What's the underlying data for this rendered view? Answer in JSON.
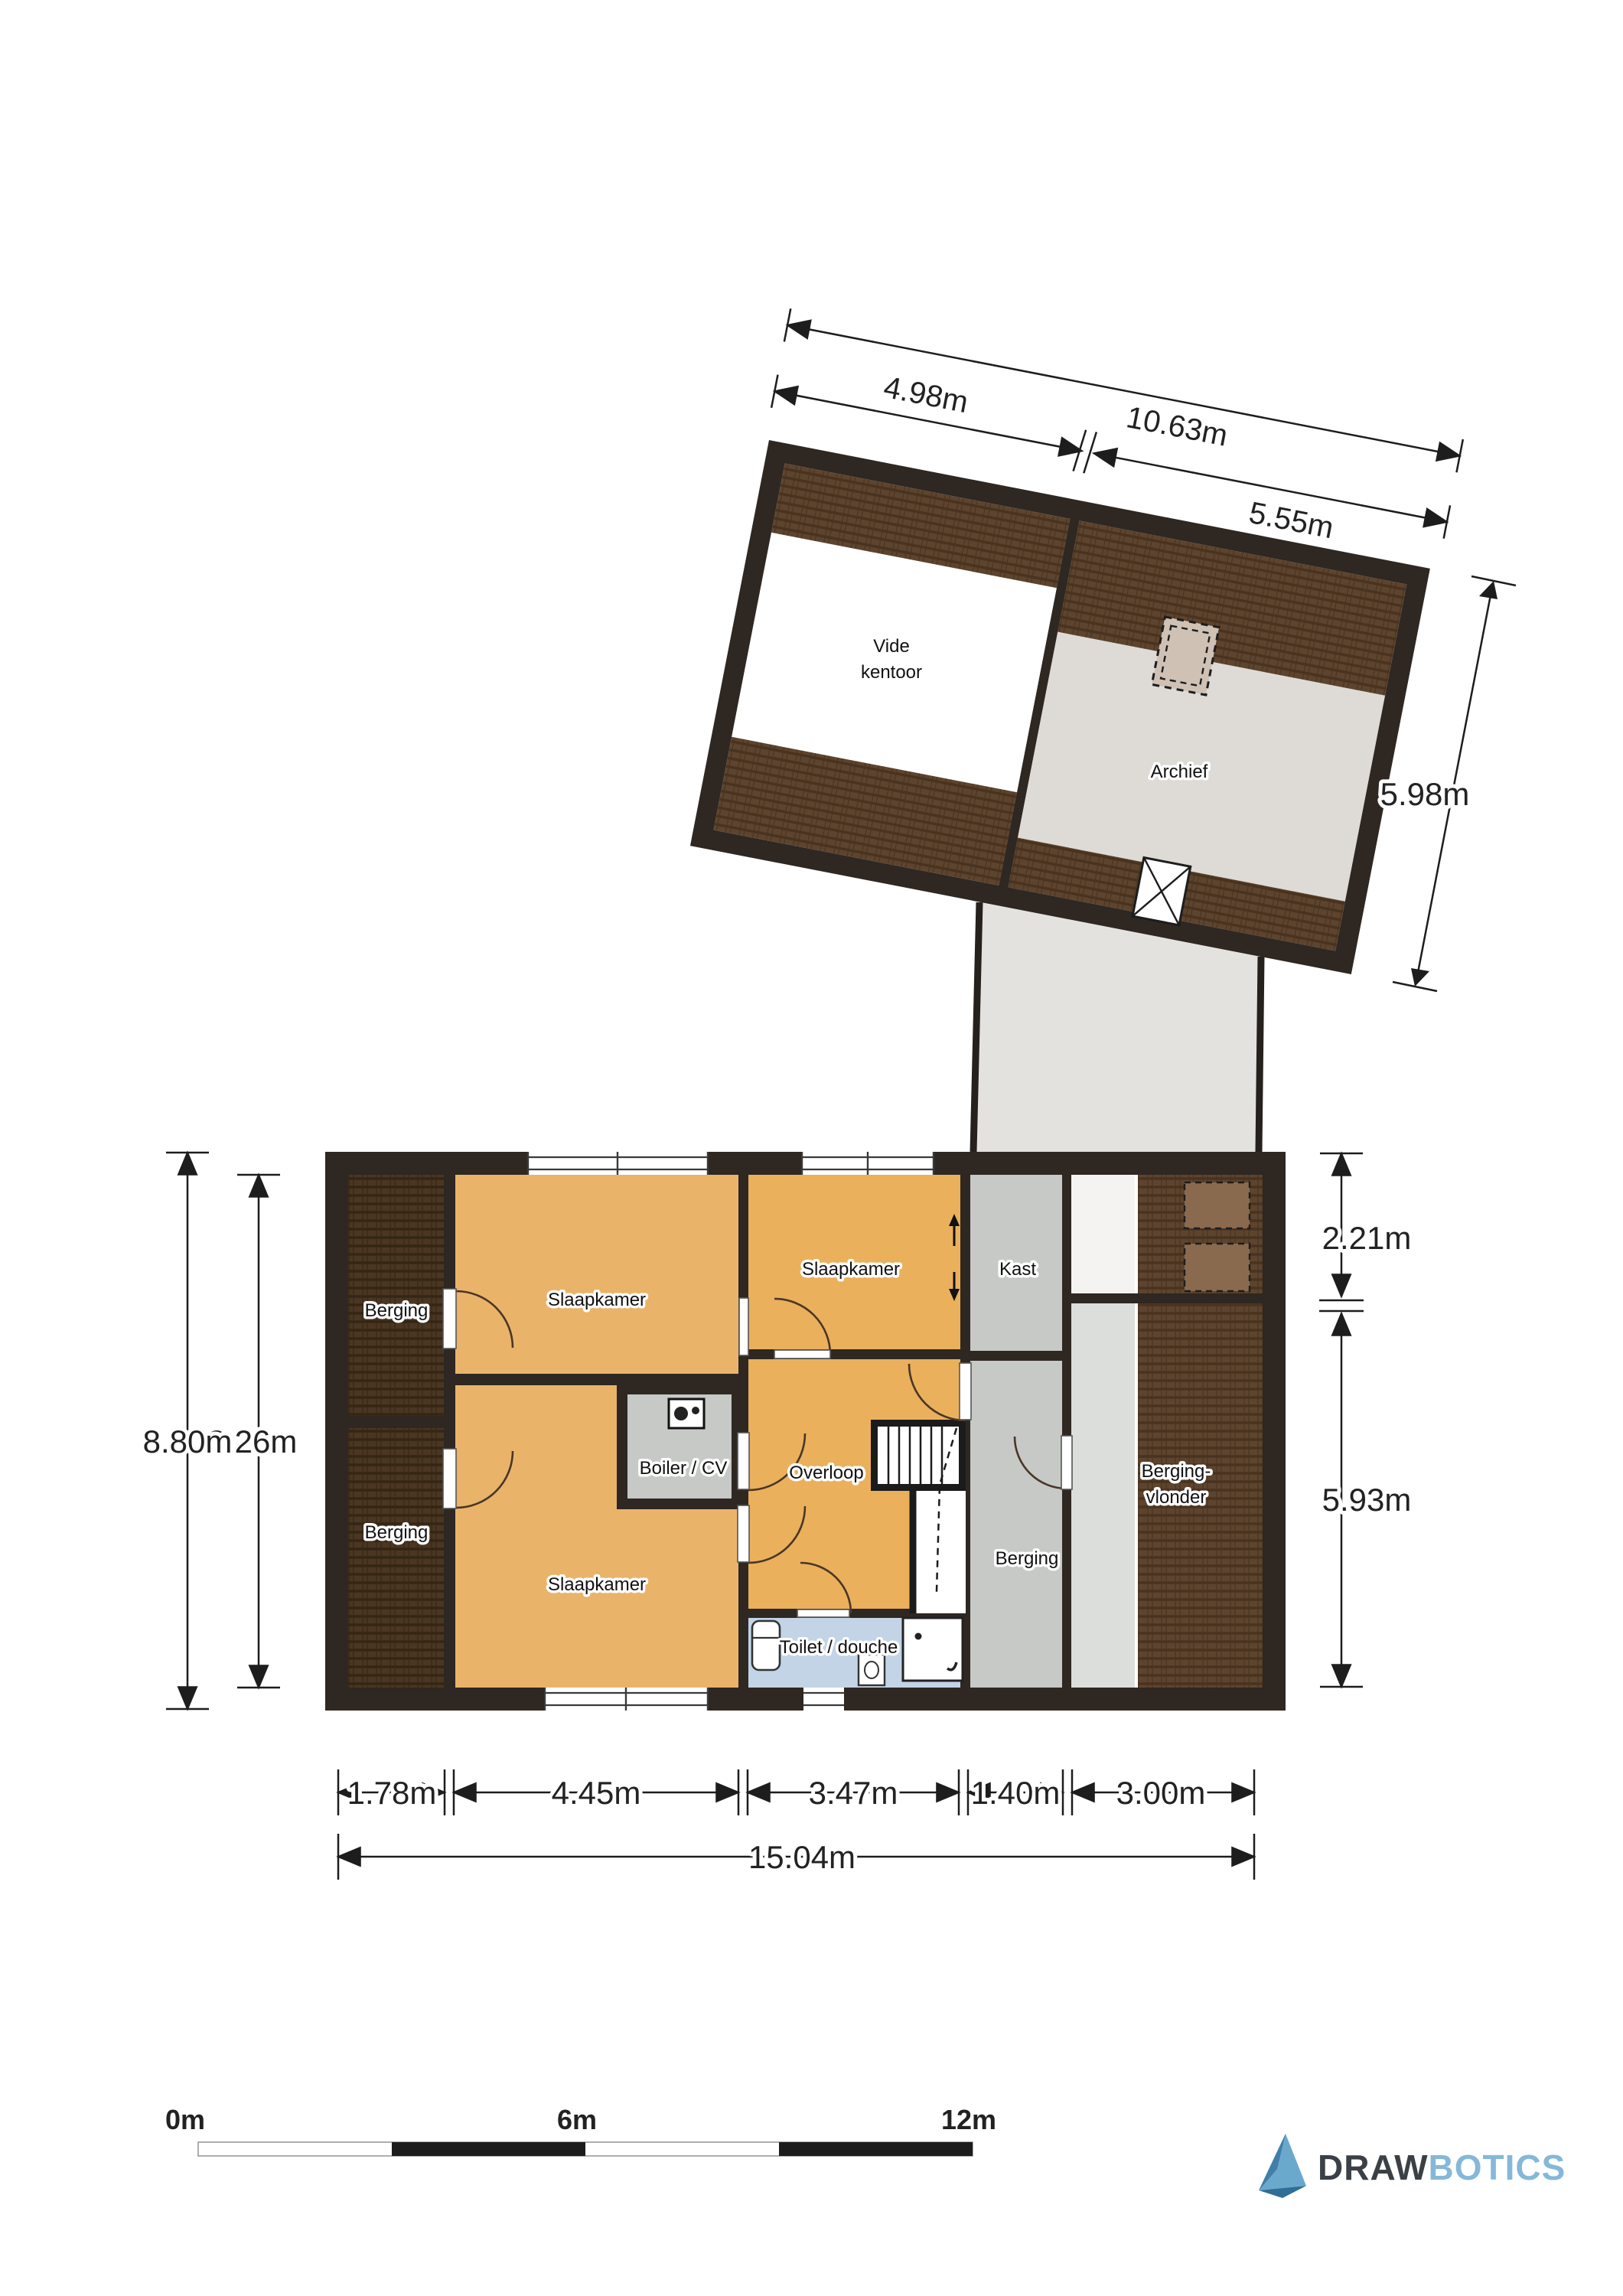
{
  "upper_unit": {
    "rooms": {
      "vide_line1": "Vide",
      "vide_line2": "kentoor",
      "archief": "Archief"
    },
    "dims": {
      "total_width": "10.63m",
      "left_width": "4.98m",
      "right_width": "5.55m",
      "height": "5.98m"
    }
  },
  "lower_unit": {
    "rooms": {
      "berging_top_left": "Berging",
      "berging_bottom_left": "Berging",
      "slaapkamer_top": "Slaapkamer",
      "slaapkamer_bottom": "Slaapkamer",
      "slaapkamer_middle": "Slaapkamer",
      "kast": "Kast",
      "boiler": "Boiler / CV",
      "overloop": "Overloop",
      "berging_middle": "Berging",
      "berging_vlonder_line1": "Berging-",
      "berging_vlonder_line2": "vlonder",
      "toilet": "Toilet / douche"
    },
    "dims": {
      "height_outer": "8.80m",
      "height_inner": "8.26m",
      "right_top": "2.21m",
      "right_bottom": "5.93m",
      "w_berging": "1.78m",
      "w_slaapkamer": "4.45m",
      "w_middle": "3.47m",
      "w_kast": "1.40m",
      "w_right": "3.00m",
      "total_width": "15.04m"
    }
  },
  "scale_bar": {
    "start": "0m",
    "middle": "6m",
    "end": "12m"
  },
  "logo": {
    "word1": "DRAW",
    "word2": "BOTICS"
  },
  "colors": {
    "wall": "#2e2722",
    "floor_orange": "#e9b46a",
    "floor_gray": "#c6c9c6",
    "floor_blue": "#c2d4e6",
    "floor_brown": "#5d442e",
    "floor_brown_dark": "#4a3622",
    "floor_light": "#dcdedb",
    "archief_floor": "#dedbd6",
    "logo_blue": "#85b8d8",
    "logo_dark": "#3a4045"
  }
}
